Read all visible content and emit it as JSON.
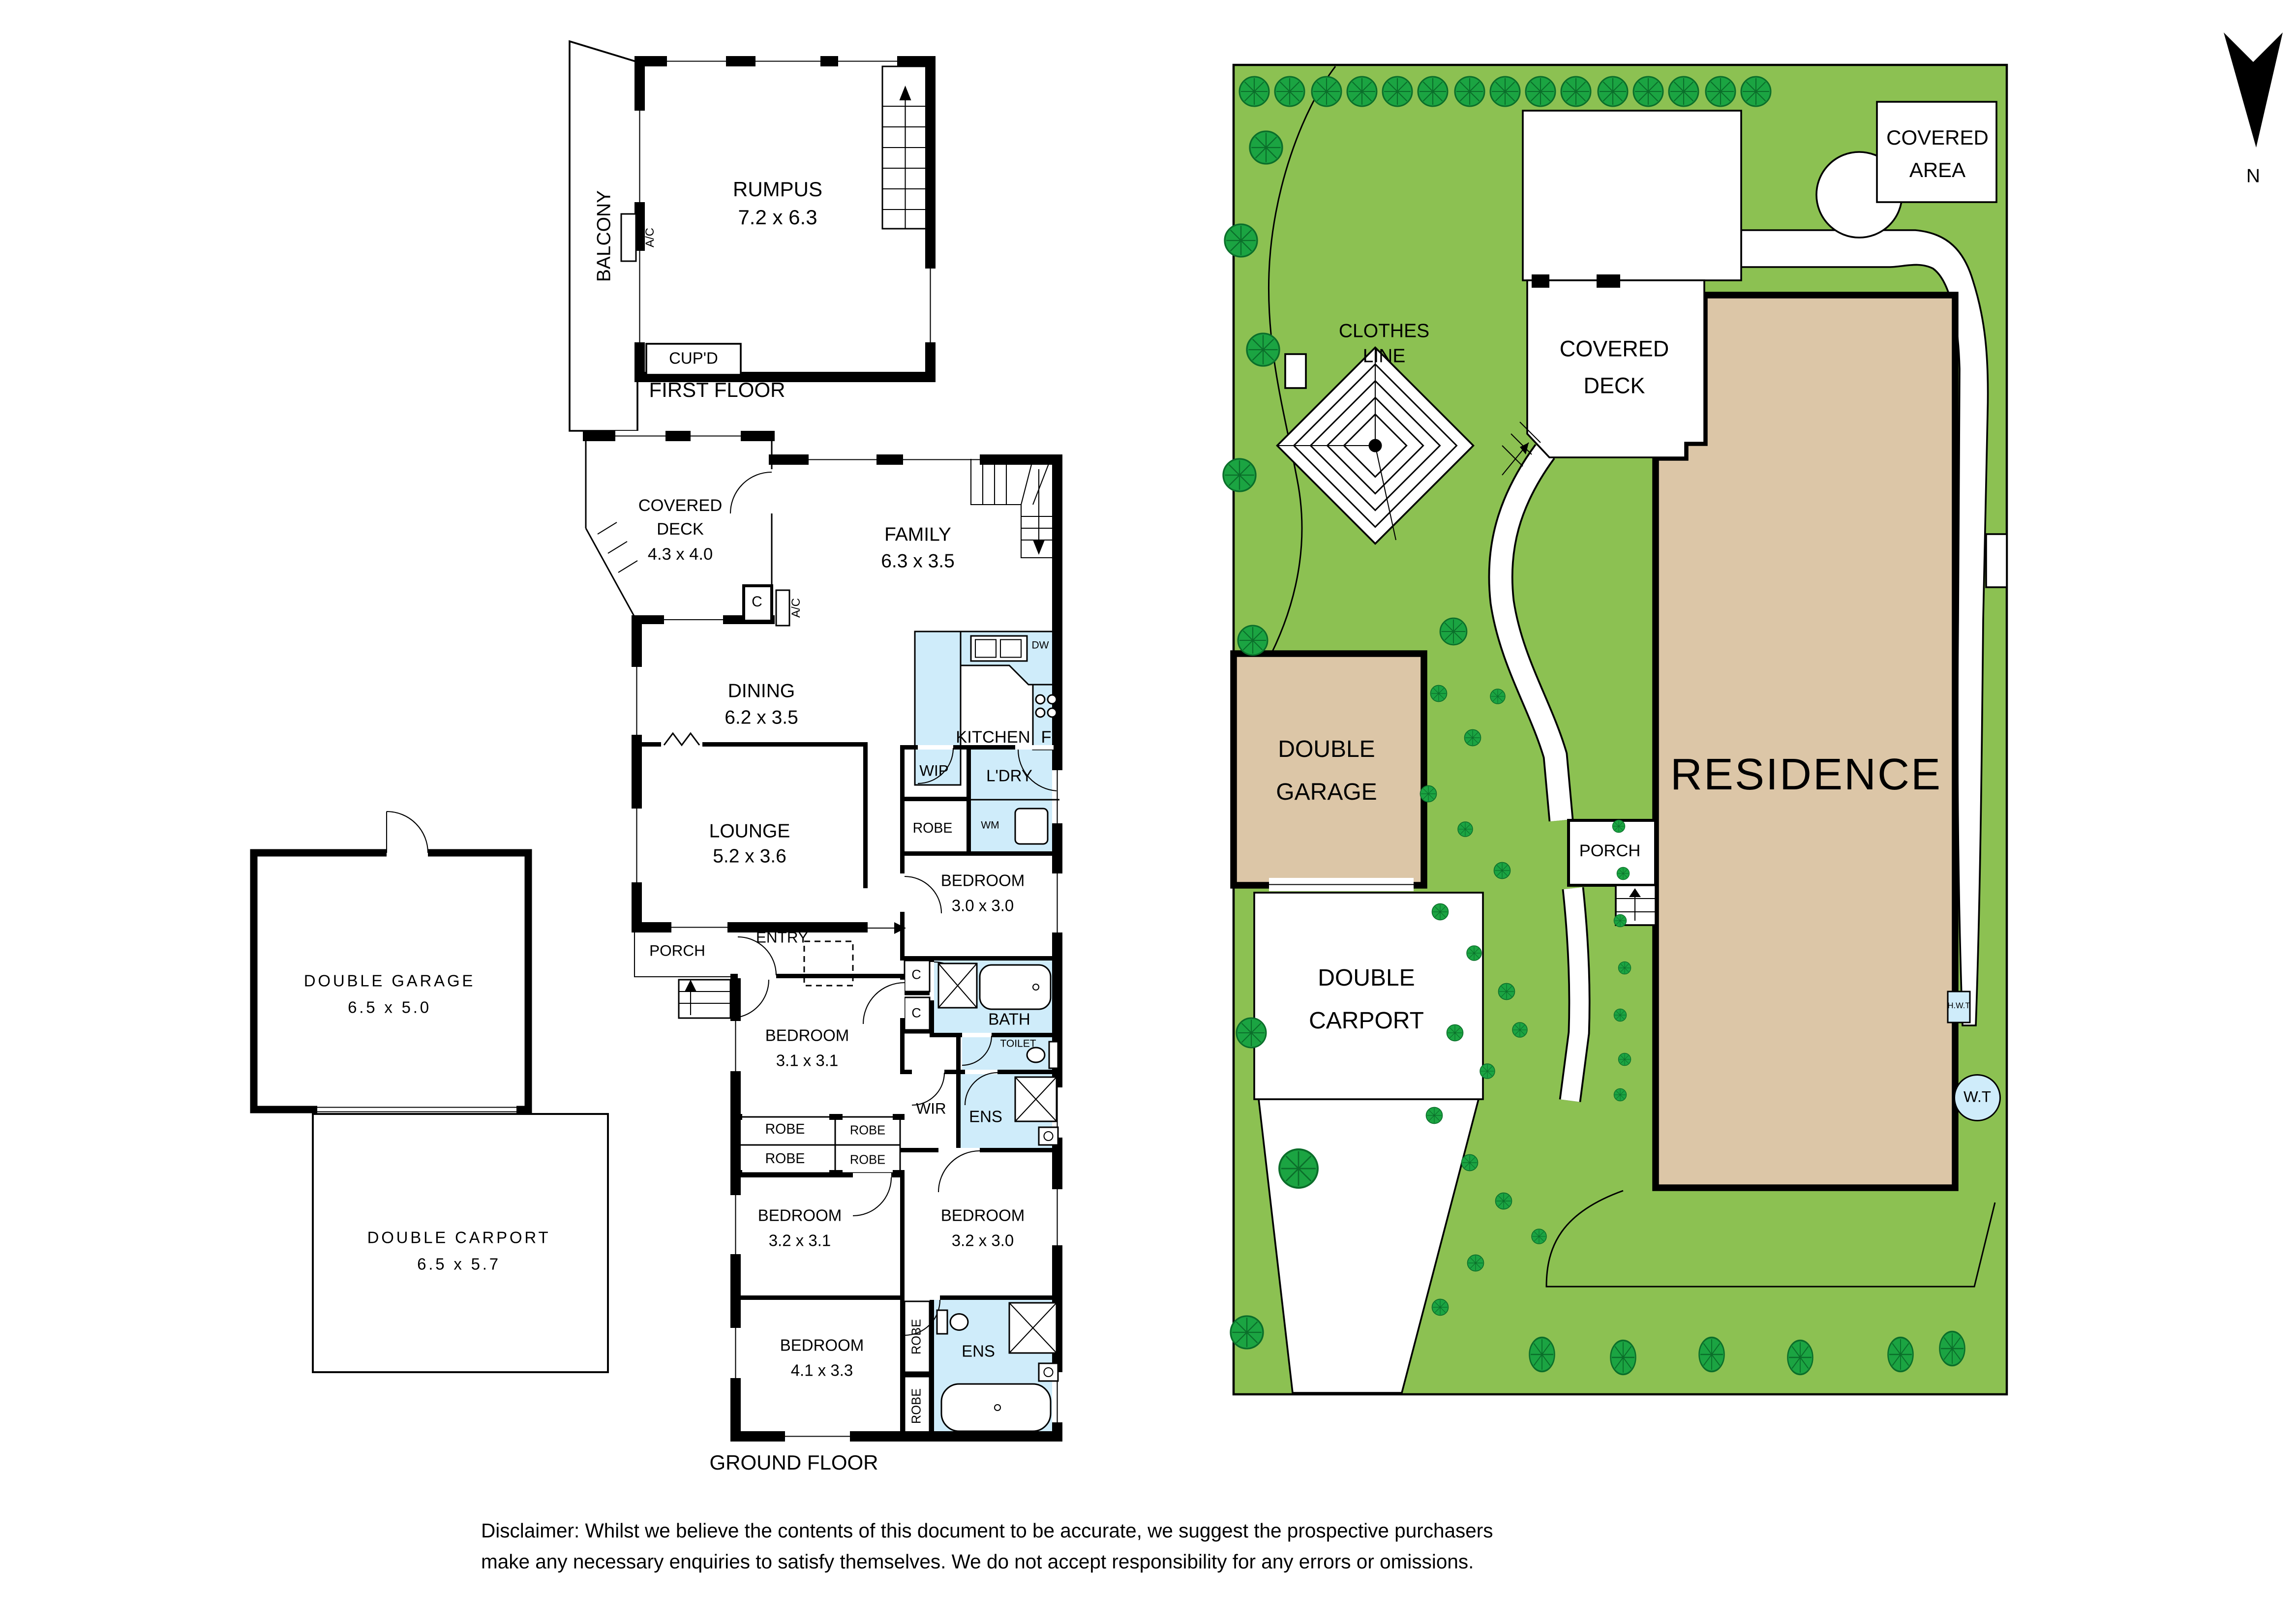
{
  "north": {
    "label": "N"
  },
  "first_floor": {
    "title": "FIRST FLOOR",
    "balcony": "BALCONY",
    "ac": "A/C",
    "rumpus_name": "RUMPUS",
    "rumpus_size": "7.2 x 6.3",
    "cupd": "CUP'D"
  },
  "ground_floor": {
    "title": "GROUND FLOOR",
    "covered_deck_l1": "COVERED",
    "covered_deck_l2": "DECK",
    "covered_deck_size": "4.3 x 4.0",
    "family_name": "FAMILY",
    "family_size": "6.3 x 3.5",
    "cupboard": "C",
    "ac": "A/C",
    "dining_name": "DINING",
    "dining_size": "6.2 x 3.5",
    "kitchen": "KITCHEN",
    "dw": "DW",
    "fridge": "F",
    "wip": "WIP",
    "ldry": "L'DRY",
    "wm": "WM",
    "robe_hall": "ROBE",
    "bedroom5_name": "BEDROOM",
    "bedroom5_size": "3.0 x 3.0",
    "lounge_name": "LOUNGE",
    "lounge_size": "5.2 x 3.6",
    "porch": "PORCH",
    "entry": "ENTRY",
    "bedroom1_name": "BEDROOM",
    "bedroom1_size": "3.1 x 3.1",
    "c1": "C",
    "c2": "C",
    "bath": "BATH",
    "toilet": "TOILET",
    "wir": "WIR",
    "ens1": "ENS",
    "robe_a": "ROBE",
    "robe_b": "ROBE",
    "robe_c": "ROBE",
    "robe_d": "ROBE",
    "bedroom2_name": "BEDROOM",
    "bedroom2_size": "3.2 x 3.1",
    "bedroom3_name": "BEDROOM",
    "bedroom3_size": "3.2 x 3.0",
    "bedroom4_name": "BEDROOM",
    "bedroom4_size": "4.1 x 3.3",
    "robe_v1": "ROBE",
    "robe_v2": "ROBE",
    "ens2": "ENS"
  },
  "outbuildings": {
    "garage_name": "DOUBLE GARAGE",
    "garage_size": "6.5 x 5.0",
    "carport_name": "DOUBLE CARPORT",
    "carport_size": "6.5 x 5.7"
  },
  "site": {
    "clothes_l1": "CLOTHES",
    "clothes_l2": "LINE",
    "deck_l1": "COVERED",
    "deck_l2": "DECK",
    "area_l1": "COVERED",
    "area_l2": "AREA",
    "garage_l1": "DOUBLE",
    "garage_l2": "GARAGE",
    "carport_l1": "DOUBLE",
    "carport_l2": "CARPORT",
    "porch": "PORCH",
    "residence": "RESIDENCE",
    "hwt": "H.W.T",
    "wt": "W.T"
  },
  "disclaimer_l1": "Disclaimer: Whilst we believe the contents of this document to be accurate, we suggest the prospective purchasers",
  "disclaimer_l2": "make any necessary enquiries to satisfy themselves. We do not accept responsibility for any errors or omissions.",
  "colors": {
    "lawn": "#8cc152",
    "tree": "#1ba442",
    "tree_dark": "#0b6e2a",
    "tan": "#dcc6a7",
    "blue": "#cfecfa"
  }
}
